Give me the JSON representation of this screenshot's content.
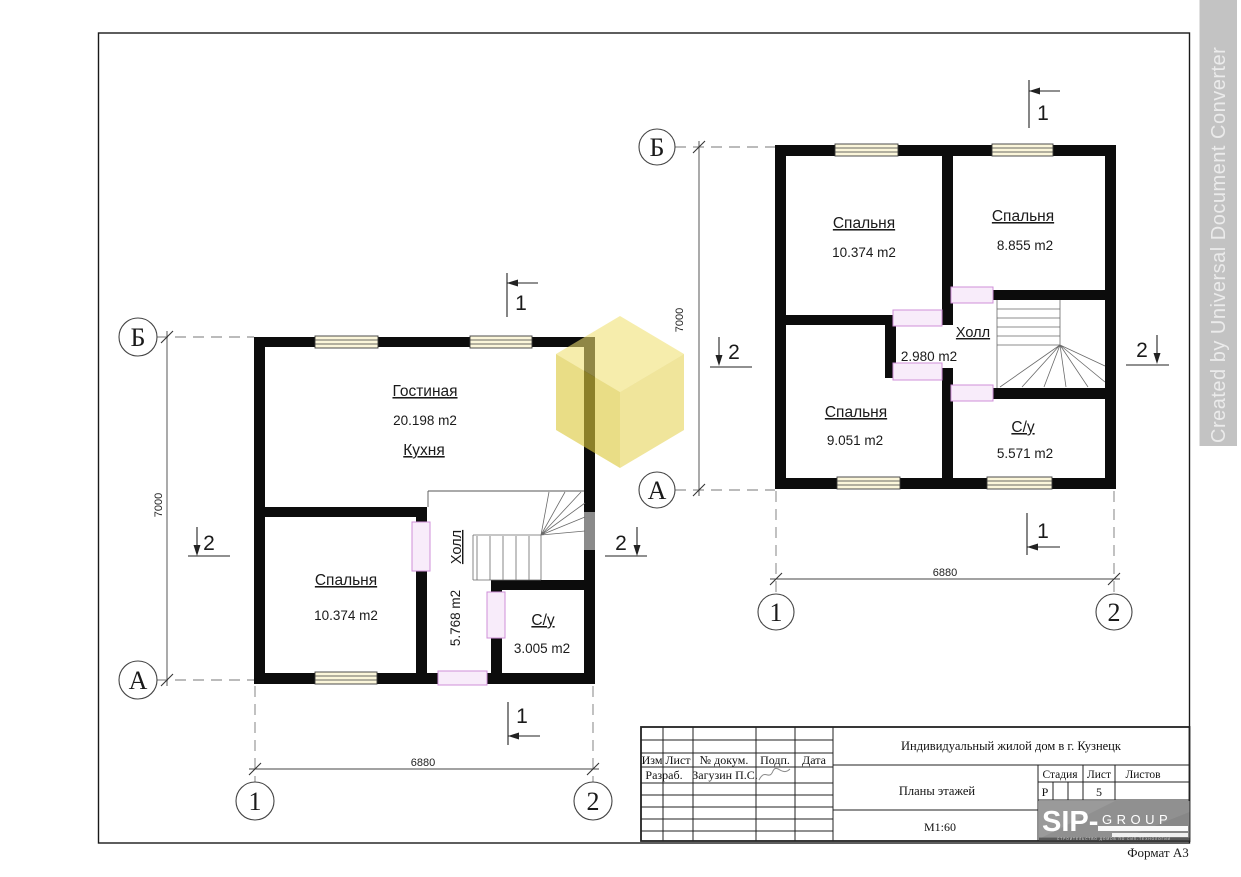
{
  "watermark": {
    "text": "Created by Universal Document Converter"
  },
  "sheet": {
    "format_label": "Формат А3"
  },
  "plans": {
    "first_floor": {
      "rooms": [
        {
          "name": "Гостиная",
          "area": "20.198 m2"
        },
        {
          "name": "Кухня",
          "area": ""
        },
        {
          "name": "Спальня",
          "area": "10.374 m2"
        },
        {
          "name": "Холл",
          "area": "5.768 m2"
        },
        {
          "name": "С/у",
          "area": "3.005 m2"
        }
      ],
      "dim_width": "6880",
      "dim_height": "7000",
      "axes": {
        "top": "Б",
        "bottom": "А",
        "left": "1",
        "right": "2"
      },
      "sections": {
        "s1": "1",
        "s2": "2"
      }
    },
    "second_floor": {
      "rooms": [
        {
          "name": "Спальня",
          "area": "10.374 m2"
        },
        {
          "name": "Спальня",
          "area": "8.855 m2"
        },
        {
          "name": "Холл",
          "area": "2.980 m2"
        },
        {
          "name": "Спальня",
          "area": "9.051 m2"
        },
        {
          "name": "С/у",
          "area": "5.571 m2"
        }
      ],
      "dim_width": "6880",
      "dim_height": "7000",
      "axes": {
        "top": "Б",
        "bottom": "А",
        "left": "1",
        "right": "2"
      },
      "sections": {
        "s1": "1",
        "s2": "2"
      }
    }
  },
  "title_block": {
    "project_title": "Индивидуальный жилой дом в г. Кузнецк",
    "drawing_title": "Планы этажей",
    "scale": "М1:60",
    "header": {
      "izm": "Изм",
      "list": "Лист",
      "doc": "№ докум.",
      "podp": "Подп.",
      "data": "Дата"
    },
    "razrab_label": "Разраб.",
    "razrab_name": "Загузин П.С.",
    "stadia": {
      "label": "Стадия",
      "value": "Р"
    },
    "list": {
      "label": "Лист",
      "value": "5"
    },
    "listov": {
      "label": "Листов",
      "value": ""
    },
    "logo": {
      "sip": "SIP-",
      "group": "GROUP",
      "tagline": "СТРОИТЕЛЬСТВО ДОМОВ ПО СИП-ТЕХНОЛОГИИ"
    }
  }
}
